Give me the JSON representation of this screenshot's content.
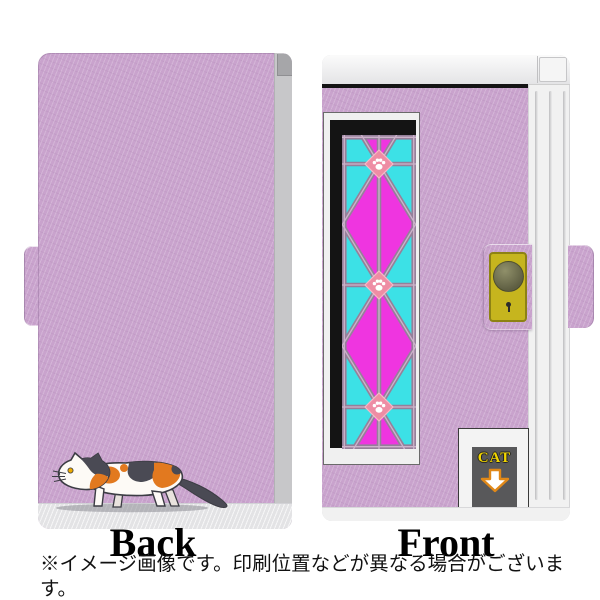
{
  "preview": {
    "back": {
      "label": "Back",
      "illustration": "calico-cat-walking"
    },
    "front": {
      "label": "Front",
      "cat_label": "CAT",
      "pattern": "asanoha-stained-glass-with-paw-prints",
      "hardware": [
        "top-edge-bar",
        "snap-button",
        "keyhole",
        "page-edge-grooves"
      ]
    },
    "notes": [
      "※イメージ画像です。印刷位置などが異なる場合がございます。",
      "※Back側には機種に応じてカメラ等の穴があきます。"
    ],
    "colors": {
      "case": "#c9a3cd",
      "pages_gray": "#c7c7c9",
      "notch_gray": "#a6a6a9",
      "edge_white": "#f1f1f1",
      "frame_black": "#141414",
      "magenta": "#ef35e0",
      "cyan": "#3ce1e6",
      "lattice": "#95809a",
      "lattice_light": "#cdb3cb",
      "paw_diamond": "#ee8da4",
      "paw_diamond_edge": "#f6b9c6",
      "gold": "#c6b51e",
      "gold_border": "#8d8214",
      "label_bg": "#58585a",
      "label_text": "#f2d600",
      "arrow_border": "#e08818",
      "cat_dark": "#4a4a54",
      "cat_orange": "#e2791f",
      "cat_white": "#fdfaf6",
      "text": "#111111"
    }
  }
}
